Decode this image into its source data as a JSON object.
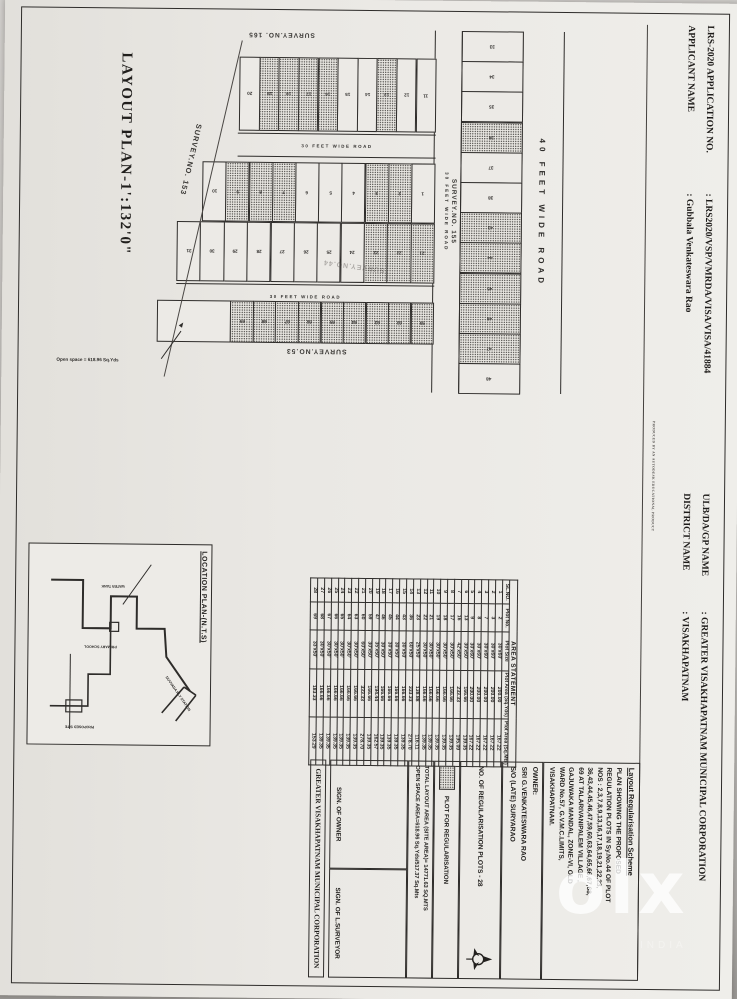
{
  "colors": {
    "paper": "#eceae6",
    "ink": "#23211f",
    "photo_bg": "#c2c0bd",
    "watermark": "#ffffff"
  },
  "watermark": {
    "text": "olx",
    "sub": "INDIA"
  },
  "header": {
    "fields": [
      {
        "label": "LRS-2020 APPLICATION NO.",
        "value": ": LRS2020/VSP/VMRDA/VISA/VISA/41884"
      },
      {
        "label": "ULB/DA/GP NAME",
        "value": ": GREATER VISAKHAPATNAM MUNICIPAL CORPORATION"
      },
      {
        "label": "APPLICANT NAME",
        "value": ": Gubbala Venkateswara Rao"
      },
      {
        "label": "DISTRICT NAME",
        "value": ": VISAKHAPATNAM"
      }
    ],
    "stamp": "PRODUCED BY AN AUTODESK EDUCATIONAL PRODUCT"
  },
  "plan": {
    "title": "LAYOUT PLAN-1':132'0\"",
    "road40": "40  FEET  WIDE  ROAD",
    "road30": "30 FEET WIDE ROAD",
    "survey153": "SURVEY.NO. 153",
    "survey155": "SURVEY.NO. 155",
    "survey165": "SURVEY.NO. 165",
    "survey53": "SURVEY.NO.53",
    "survey44": "SURVEY.NO.44",
    "open_space_note": "Open space = 618.96 Sq.Yds",
    "top_row": [
      {
        "n": "33"
      },
      {
        "n": "34"
      },
      {
        "n": "35"
      },
      {
        "n": "36",
        "h": 1
      },
      {
        "n": "37"
      },
      {
        "n": "38"
      },
      {
        "n": "43",
        "h": 1
      },
      {
        "n": "44",
        "h": 1
      },
      {
        "n": "45",
        "h": 1
      },
      {
        "n": "46",
        "h": 1
      },
      {
        "n": "47",
        "h": 1
      },
      {
        "n": "48"
      }
    ],
    "columns": [
      {
        "plots": [
          {
            "n": "11"
          },
          {
            "n": "12"
          },
          {
            "n": "13",
            "h": 1
          },
          {
            "n": "14"
          },
          {
            "n": "15"
          },
          {
            "n": "16",
            "h": 1
          },
          {
            "n": "17",
            "h": 1
          },
          {
            "n": "18",
            "h": 1
          },
          {
            "n": "19",
            "h": 1
          },
          {
            "n": "20"
          }
        ]
      },
      {
        "plots": [
          {
            "n": "1"
          },
          {
            "n": "2",
            "h": 1
          },
          {
            "n": "3",
            "h": 1
          },
          {
            "n": "4"
          },
          {
            "n": "5"
          },
          {
            "n": "6"
          },
          {
            "n": "7",
            "h": 1
          },
          {
            "n": "8",
            "h": 1
          },
          {
            "n": "9",
            "h": 1
          },
          {
            "n": "10"
          }
        ]
      },
      {
        "plots": [
          {
            "n": "21",
            "h": 1
          },
          {
            "n": "22",
            "h": 1
          },
          {
            "n": "23",
            "h": 1
          },
          {
            "n": "24"
          },
          {
            "n": "25"
          },
          {
            "n": "26"
          },
          {
            "n": "27"
          },
          {
            "n": "28"
          },
          {
            "n": "29"
          },
          {
            "n": "30"
          },
          {
            "n": "31"
          }
        ]
      },
      {
        "plots": [
          {
            "n": "59",
            "h": 1
          },
          {
            "n": "60",
            "h": 1
          },
          {
            "n": "63",
            "h": 1
          },
          {
            "n": "64",
            "h": 1
          },
          {
            "n": "65",
            "h": 1
          },
          {
            "n": "66",
            "h": 1
          },
          {
            "n": "67",
            "h": 1
          },
          {
            "n": "68",
            "h": 1
          },
          {
            "n": "69",
            "h": 1
          }
        ],
        "open": true
      }
    ]
  },
  "table": {
    "title": "AREA STATEMENT",
    "headers": [
      "SL.NO.",
      "Plot No.",
      "Plot Size",
      "Plot Area (Sq.Yds)",
      "Plot Area (Sq.Mts)"
    ],
    "rows": [
      [
        "1",
        "2",
        "30'x60'",
        "200.00",
        "167.22"
      ],
      [
        "2",
        "3",
        "30'x60'",
        "200.00",
        "167.22"
      ],
      [
        "3",
        "7",
        "30'x60'",
        "200.00",
        "167.22"
      ],
      [
        "4",
        "8",
        "30'x60'",
        "200.00",
        "167.22"
      ],
      [
        "5",
        "9",
        "30'x60'",
        "200.00",
        "167.22"
      ],
      [
        "6",
        "13",
        "30'x50'",
        "166.66",
        "139.35"
      ],
      [
        "7",
        "16",
        "42'x50'",
        "233.33",
        "195.09"
      ],
      [
        "8",
        "17",
        "30'x50'",
        "166.66",
        "139.35"
      ],
      [
        "9",
        "18",
        "30'x50'",
        "166.66",
        "139.35"
      ],
      [
        "10",
        "19",
        "30'x50'",
        "166.66",
        "139.35"
      ],
      [
        "11",
        "21",
        "30'x50'",
        "166.66",
        "139.35"
      ],
      [
        "12",
        "22",
        "30'x50'",
        "166.66",
        "139.35"
      ],
      [
        "13",
        "23",
        "25'x50'",
        "138.88",
        "116.11"
      ],
      [
        "14",
        "36",
        "60'x50'",
        "333.33",
        "278.70"
      ],
      [
        "15",
        "43",
        "30'x50'",
        "166.66",
        "139.35"
      ],
      [
        "16",
        "44",
        "30'x50'",
        "166.66",
        "139.35"
      ],
      [
        "17",
        "45",
        "30'x50'",
        "166.66",
        "139.35"
      ],
      [
        "18",
        "46",
        "30'x50'",
        "166.66",
        "139.35"
      ],
      [
        "19",
        "47",
        "35'x50'",
        "194.44",
        "162.57"
      ],
      [
        "20",
        "59",
        "30'x50'",
        "166.66",
        "139.35"
      ],
      [
        "21",
        "60",
        "60'x50'",
        "333.33",
        "278.70"
      ],
      [
        "22",
        "63",
        "30'x50'",
        "166.66",
        "139.35"
      ],
      [
        "23",
        "64",
        "30'x50'",
        "166.66",
        "139.35"
      ],
      [
        "24",
        "65",
        "30'x50'",
        "166.66",
        "139.35"
      ],
      [
        "25",
        "66",
        "30'x50'",
        "166.66",
        "139.35"
      ],
      [
        "26",
        "67",
        "30'x50'",
        "166.66",
        "139.35"
      ],
      [
        "27",
        "68",
        "30'x50'",
        "166.66",
        "139.35"
      ],
      [
        "28",
        "69",
        "33'x50'",
        "183.33",
        "153.29"
      ]
    ]
  },
  "scheme": {
    "title": "Layout Regularisation Scheme",
    "lines": [
      "PLAN SHOWING THE PROPOSED",
      "REGULATION PLOTS IN Sy.No.44 OF PLOT",
      "NOS : 2,3,7,8,9,13,16,17,18,19,21,22,23,",
      "36,43,44,45,46,47,59,60,63,64,65,66,67,68,",
      "69 AT TALARIVANIPALEM VILLAGE ,",
      "GAJUWAKA MANDAL, ZONE-VI, OLD",
      "WARD No.57, G.V.M.C.LIMITS,",
      "VISAKHAPATNAM."
    ]
  },
  "owner": {
    "label": "OWNER:",
    "name": "SRI G.VENKATESWARA RAO",
    "relation": "S/O (LATE) SURYARAO"
  },
  "counts": {
    "reg_plots": "NO. OF REGULARISATION PLOTS  -  28"
  },
  "legend": {
    "label": "PLOT FOR REGULARISATION"
  },
  "totals": {
    "line1": "TOTAL LAYOUT AREA (SITE AREA)= 14771.63 SQ.MTS",
    "line2": "OPEN SPACE AREA=618.96 Sq.Yds/517.37 Sq.Mts"
  },
  "signs": {
    "owner": "SIGN. OF OWNER",
    "surveyor": "SIGN. OF L.SURVEYOR"
  },
  "footer_box": "GREATER VISAKHAPATNAM MUNICIPAL CORPORATION",
  "location": {
    "title": "LOCATION PLAN-(N.T.S)",
    "labels": [
      {
        "text": "DUVVADA RLY STATION",
        "x": 128,
        "y": 30,
        "rot": -35
      },
      {
        "text": "WATER TANK",
        "x": 30,
        "y": 96,
        "rot": 90
      },
      {
        "text": "PRIMARY SCHOOL",
        "x": 86,
        "y": 108,
        "rot": 90
      },
      {
        "text": "PROPOSED SITE",
        "x": 168,
        "y": 128,
        "rot": 90
      }
    ]
  }
}
